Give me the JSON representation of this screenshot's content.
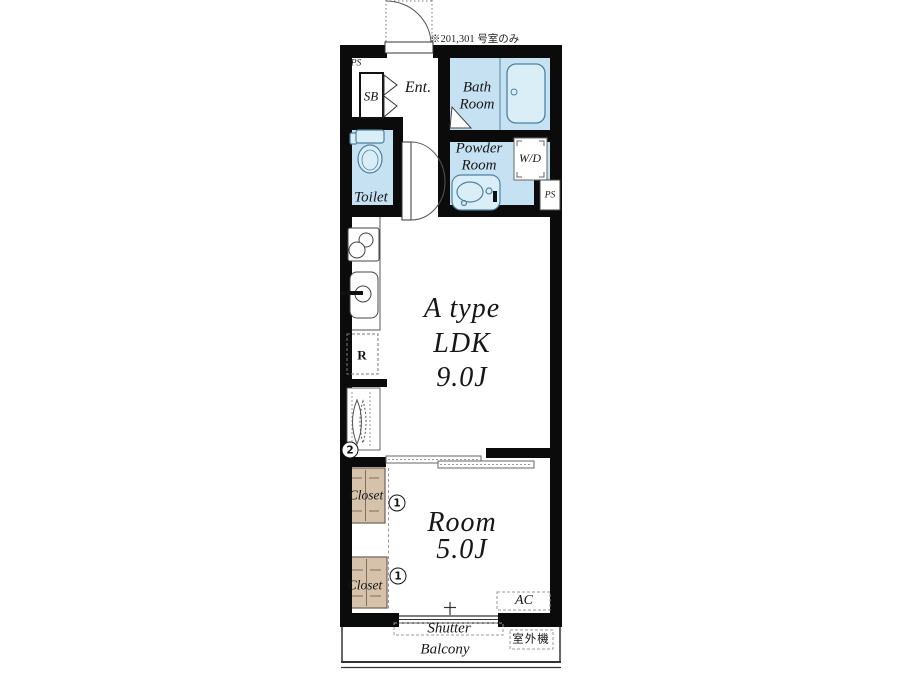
{
  "note": "※201,301 号室のみ",
  "unit": {
    "ldk": {
      "line1": "A type",
      "line2": "LDK",
      "line3": "9.0J"
    },
    "bedroom": {
      "line1": "Room",
      "line2": "5.0J"
    }
  },
  "rooms": {
    "entrance": "Ent.",
    "bath_line1": "Bath",
    "bath_line2": "Room",
    "toilet": "Toilet",
    "powder_line1": "Powder",
    "powder_line2": "Room",
    "balcony": "Balcony"
  },
  "features": {
    "ps_top": "PS",
    "shoe_box": "SB",
    "washer_dryer": "W/D",
    "ps_mid": "PS",
    "refrigerator": "R",
    "closet_upper": "Closet",
    "closet_lower": "Closet",
    "ac": "AC",
    "shutter": "Shutter",
    "outdoor_unit": "室外機"
  },
  "markers": {
    "window_num": "2",
    "closet_upper_num": "1",
    "closet_lower_num": "1"
  },
  "colors": {
    "wet_area_fill": "#c6e2f2",
    "fixture_fill": "#daeef8",
    "fixture_stroke": "#4e81a0",
    "closet_fill": "#d6c2ab",
    "wall": "#0b0b0b",
    "background": "#ffffff"
  }
}
